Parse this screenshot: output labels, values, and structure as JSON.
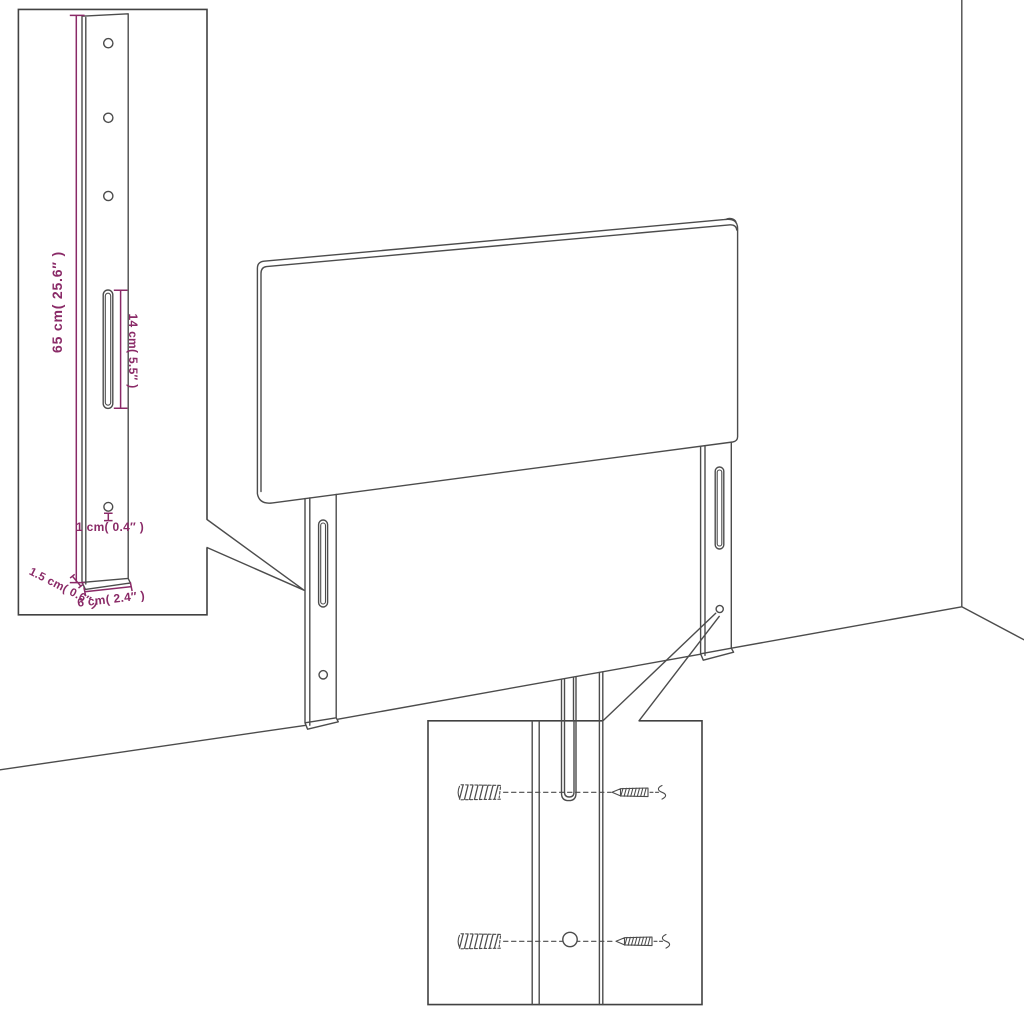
{
  "page": {
    "background": "#ffffff",
    "description": "Technical assembly diagram of a headboard with two wall-mounting legs"
  },
  "colors": {
    "line": "#4c4c4c",
    "dimension": "#8a2a67"
  },
  "main_view": {
    "subject": "headboard panel with two slotted mounting legs standing in a room corner"
  },
  "leg_detail": {
    "dim_height": "65 cm( 25.6″ )",
    "dim_slot_length": "14 cm( 5.5″ )",
    "dim_hole": "1 cm( 0.4″ )",
    "dim_depth": "1.5 cm( 0.6″ )",
    "dim_width": "6 cm( 2.4″ )",
    "screw_hole_count": 4,
    "slot_count": 1
  },
  "mounting_detail": {
    "wall_plug_count": 2,
    "screw_count": 2,
    "icons": [
      "wall-plug-icon",
      "screw-icon"
    ]
  }
}
